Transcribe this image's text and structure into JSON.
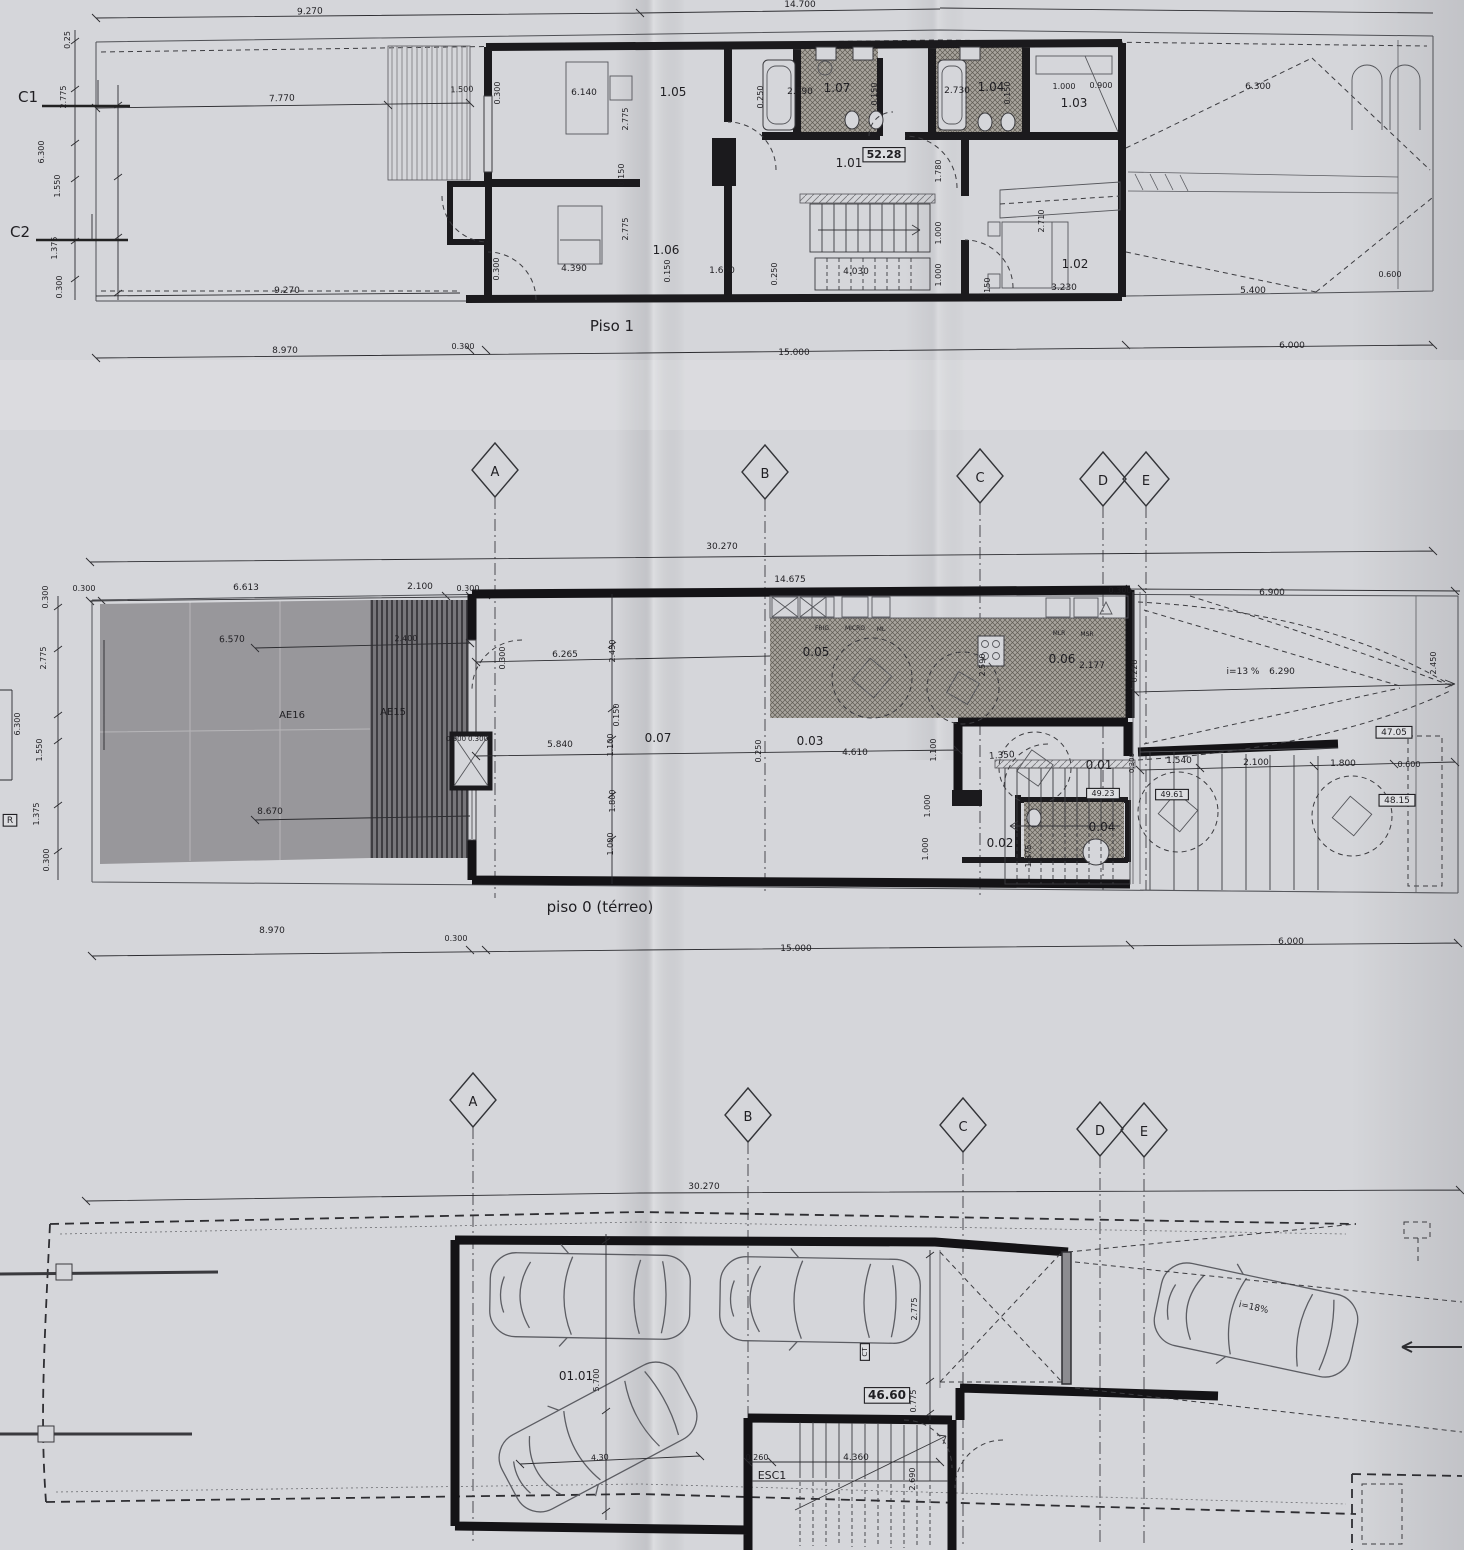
{
  "document": {
    "kind": "scanned architectural plan sheet (photograph of folded print)",
    "plans": [
      {
        "title": "Piso 1",
        "rooms": [
          "1.01",
          "1.02",
          "1.03",
          "1.04",
          "1.05",
          "1.06",
          "1.07"
        ],
        "level_box": "52.28"
      },
      {
        "title": "piso 0 (térreo)",
        "rooms": [
          "0.01",
          "0.02",
          "0.03",
          "0.04",
          "0.05",
          "0.06",
          "0.07"
        ],
        "zones": [
          "AE16",
          "AE15"
        ],
        "level_boxes": [
          "47.05",
          "48.15",
          "49.23",
          "49.61"
        ],
        "ramp": "i=13 %"
      },
      {
        "title": "garagem (piso -1)",
        "rooms": [
          "01.01"
        ],
        "level_box": "46.60",
        "refs": [
          "ESC1",
          "CT"
        ],
        "ramp": "i=18%"
      }
    ],
    "grid_letters": [
      "A",
      "B",
      "C",
      "D",
      "E"
    ],
    "section_refs": [
      "C1",
      "C2",
      "R"
    ],
    "overall_dim": "30.270"
  },
  "colors": {
    "paper": "#d5d6da",
    "ink": "#1f1e22",
    "wall": "#1b1a1d",
    "terrace_gray": "#98979b",
    "deck_dark": "#6e6d70",
    "hatch_base": "#a8a49d"
  },
  "labels": [
    {
      "n": "dim-label",
      "t": "9.270",
      "x": 310,
      "y": 14,
      "fs": 9,
      "r": -2
    },
    {
      "n": "dim-label",
      "t": "14.700",
      "x": 800,
      "y": 7,
      "fs": 9
    },
    {
      "n": "section-ref",
      "t": "C1",
      "x": 28,
      "y": 102,
      "fs": 15
    },
    {
      "n": "section-ref",
      "t": "C2",
      "x": 20,
      "y": 237,
      "fs": 15
    },
    {
      "n": "dim-label",
      "t": "0.25",
      "x": 70,
      "y": 40,
      "fs": 8,
      "r": -90
    },
    {
      "n": "dim-label",
      "t": "2.775",
      "x": 66,
      "y": 97,
      "fs": 8,
      "r": -90
    },
    {
      "n": "dim-label",
      "t": "6.300",
      "x": 44,
      "y": 152,
      "fs": 8,
      "r": -90
    },
    {
      "n": "dim-label",
      "t": "1.550",
      "x": 60,
      "y": 186,
      "fs": 8,
      "r": -90
    },
    {
      "n": "dim-label",
      "t": "1.375",
      "x": 57,
      "y": 248,
      "fs": 8,
      "r": -90
    },
    {
      "n": "dim-label",
      "t": "0.300",
      "x": 62,
      "y": 287,
      "fs": 8,
      "r": -90
    },
    {
      "n": "dim-label",
      "t": "7.770",
      "x": 282,
      "y": 101,
      "fs": 9,
      "r": -2
    },
    {
      "n": "dim-label",
      "t": "1.500",
      "x": 462,
      "y": 92,
      "fs": 8,
      "r": -2
    },
    {
      "n": "dim-label",
      "t": "0.300",
      "x": 500,
      "y": 93,
      "fs": 8,
      "r": -90
    },
    {
      "n": "dim-label",
      "t": "6.140",
      "x": 584,
      "y": 95,
      "fs": 9
    },
    {
      "n": "room-label",
      "t": "1.05",
      "x": 673,
      "y": 96,
      "fs": 12
    },
    {
      "n": "dim-label",
      "t": "0.250",
      "x": 763,
      "y": 97,
      "fs": 8,
      "r": -90
    },
    {
      "n": "dim-label",
      "t": "2.590",
      "x": 800,
      "y": 94,
      "fs": 9
    },
    {
      "n": "room-label",
      "t": "1.07",
      "x": 837,
      "y": 92,
      "fs": 12
    },
    {
      "n": "dim-label",
      "t": "0.150",
      "x": 877,
      "y": 94,
      "fs": 8,
      "r": -90
    },
    {
      "n": "dim-label",
      "t": "2.730",
      "x": 957,
      "y": 93,
      "fs": 9
    },
    {
      "n": "room-label",
      "t": "1.04",
      "x": 991,
      "y": 91,
      "fs": 12
    },
    {
      "n": "dim-label",
      "t": "0.150",
      "x": 1010,
      "y": 93,
      "fs": 8,
      "r": -90
    },
    {
      "n": "dim-label",
      "t": "1.000",
      "x": 1064,
      "y": 89,
      "fs": 8
    },
    {
      "n": "dim-label",
      "t": "0.900",
      "x": 1101,
      "y": 88,
      "fs": 8
    },
    {
      "n": "room-label",
      "t": "1.03",
      "x": 1074,
      "y": 107,
      "fs": 12
    },
    {
      "n": "dim-label",
      "t": "6.300",
      "x": 1258,
      "y": 89,
      "fs": 9
    },
    {
      "n": "dim-label",
      "t": "2.775",
      "x": 628,
      "y": 119,
      "fs": 8,
      "r": -90
    },
    {
      "n": "dim-label",
      "t": "0.150",
      "x": 624,
      "y": 175,
      "fs": 8,
      "r": -90
    },
    {
      "n": "dim-label",
      "t": "2.775",
      "x": 628,
      "y": 229,
      "fs": 8,
      "r": -90
    },
    {
      "n": "level-box",
      "t": "52.28",
      "x": 884,
      "y": 158,
      "fs": 11,
      "b": 1,
      "box": 1
    },
    {
      "n": "room-label",
      "t": "1.01",
      "x": 849,
      "y": 167,
      "fs": 12
    },
    {
      "n": "dim-label",
      "t": "1.780",
      "x": 941,
      "y": 171,
      "fs": 8,
      "r": -90
    },
    {
      "n": "dim-label",
      "t": "1.000",
      "x": 941,
      "y": 233,
      "fs": 8,
      "r": -90
    },
    {
      "n": "dim-label",
      "t": "1.000",
      "x": 941,
      "y": 275,
      "fs": 8,
      "r": -90
    },
    {
      "n": "dim-label",
      "t": "2.710",
      "x": 1044,
      "y": 221,
      "fs": 8,
      "r": -90
    },
    {
      "n": "room-label",
      "t": "1.06",
      "x": 666,
      "y": 254,
      "fs": 12
    },
    {
      "n": "room-label",
      "t": "1.02",
      "x": 1075,
      "y": 268,
      "fs": 12
    },
    {
      "n": "dim-label",
      "t": "4.390",
      "x": 574,
      "y": 271,
      "fs": 9
    },
    {
      "n": "dim-label",
      "t": "0.150",
      "x": 670,
      "y": 271,
      "fs": 8,
      "r": -90
    },
    {
      "n": "dim-label",
      "t": "1.600",
      "x": 722,
      "y": 273,
      "fs": 9
    },
    {
      "n": "dim-label",
      "t": "0.250",
      "x": 777,
      "y": 274,
      "fs": 8,
      "r": -90
    },
    {
      "n": "dim-label",
      "t": "4.030",
      "x": 856,
      "y": 274,
      "fs": 9
    },
    {
      "n": "dim-label",
      "t": "0.300",
      "x": 499,
      "y": 269,
      "fs": 8,
      "r": -90
    },
    {
      "n": "dim-label",
      "t": "0.150",
      "x": 990,
      "y": 289,
      "fs": 8,
      "r": -90
    },
    {
      "n": "dim-label",
      "t": "3.230",
      "x": 1064,
      "y": 290,
      "fs": 9
    },
    {
      "n": "dim-label",
      "t": "5.400",
      "x": 1253,
      "y": 293,
      "fs": 9
    },
    {
      "n": "dim-label",
      "t": "0.600",
      "x": 1390,
      "y": 277,
      "fs": 8
    },
    {
      "n": "dim-label",
      "t": "9.270",
      "x": 287,
      "y": 293,
      "fs": 9
    },
    {
      "n": "plan-title",
      "t": "Piso 1",
      "x": 612,
      "y": 331,
      "fs": 15
    },
    {
      "n": "dim-label",
      "t": "8.970",
      "x": 285,
      "y": 353,
      "fs": 9
    },
    {
      "n": "dim-label",
      "t": "0.300",
      "x": 463,
      "y": 349,
      "fs": 8
    },
    {
      "n": "dim-label",
      "t": "15.000",
      "x": 794,
      "y": 355,
      "fs": 9
    },
    {
      "n": "dim-label",
      "t": "6.000",
      "x": 1292,
      "y": 348,
      "fs": 9
    },
    {
      "n": "grid-letter",
      "t": "A",
      "x": 495,
      "y": 476,
      "fs": 13
    },
    {
      "n": "grid-letter",
      "t": "B",
      "x": 765,
      "y": 478,
      "fs": 13
    },
    {
      "n": "grid-letter",
      "t": "C",
      "x": 980,
      "y": 482,
      "fs": 13
    },
    {
      "n": "grid-letter",
      "t": "D",
      "x": 1103,
      "y": 485,
      "fs": 13
    },
    {
      "n": "grid-letter",
      "t": "E",
      "x": 1146,
      "y": 485,
      "fs": 13
    },
    {
      "n": "dim-label",
      "t": "30.270",
      "x": 722,
      "y": 549,
      "fs": 9
    },
    {
      "n": "dim-label",
      "t": "0.300",
      "x": 84,
      "y": 591,
      "fs": 8
    },
    {
      "n": "dim-label",
      "t": "6.613",
      "x": 246,
      "y": 590,
      "fs": 9
    },
    {
      "n": "dim-label",
      "t": "2.100",
      "x": 420,
      "y": 589,
      "fs": 9
    },
    {
      "n": "dim-label",
      "t": "0.300",
      "x": 468,
      "y": 591,
      "fs": 8
    },
    {
      "n": "dim-label",
      "t": "14.675",
      "x": 790,
      "y": 582,
      "fs": 9
    },
    {
      "n": "dim-label",
      "t": "0.300",
      "x": 1120,
      "y": 593,
      "fs": 8
    },
    {
      "n": "dim-label",
      "t": "6.900",
      "x": 1272,
      "y": 595,
      "fs": 9
    },
    {
      "n": "dim-label",
      "t": "0.300",
      "x": 48,
      "y": 597,
      "fs": 8,
      "r": -90
    },
    {
      "n": "dim-label",
      "t": "2.775",
      "x": 46,
      "y": 658,
      "fs": 8,
      "r": -90
    },
    {
      "n": "dim-label",
      "t": "6.300",
      "x": 20,
      "y": 724,
      "fs": 8,
      "r": -90
    },
    {
      "n": "dim-label",
      "t": "1.550",
      "x": 42,
      "y": 750,
      "fs": 8,
      "r": -90
    },
    {
      "n": "dim-label",
      "t": "1.375",
      "x": 39,
      "y": 814,
      "fs": 8,
      "r": -90
    },
    {
      "n": "dim-label",
      "t": "0.300",
      "x": 49,
      "y": 860,
      "fs": 8,
      "r": -90
    },
    {
      "n": "section-ref",
      "t": "R",
      "x": 10,
      "y": 823,
      "fs": 9,
      "box": 1
    },
    {
      "n": "dim-label",
      "t": "6.570",
      "x": 232,
      "y": 642,
      "fs": 9,
      "r": -1
    },
    {
      "n": "zone-label",
      "t": "AE16",
      "x": 292,
      "y": 718,
      "fs": 10
    },
    {
      "n": "zone-label",
      "t": "AE15",
      "x": 393,
      "y": 715,
      "fs": 10
    },
    {
      "n": "dim-label",
      "t": "8.670",
      "x": 270,
      "y": 814,
      "fs": 9
    },
    {
      "n": "dim-label",
      "t": "2.400",
      "x": 406,
      "y": 641,
      "fs": 8,
      "r": -1
    },
    {
      "n": "dim-label",
      "t": "0.900",
      "x": 456,
      "y": 741,
      "fs": 7
    },
    {
      "n": "dim-label",
      "t": "0.300",
      "x": 478,
      "y": 741,
      "fs": 7
    },
    {
      "n": "dim-label",
      "t": "0.300",
      "x": 505,
      "y": 658,
      "fs": 8,
      "r": -90
    },
    {
      "n": "dim-label",
      "t": "6.265",
      "x": 565,
      "y": 657,
      "fs": 9
    },
    {
      "n": "dim-label",
      "t": "2.450",
      "x": 615,
      "y": 651,
      "fs": 8,
      "r": -90
    },
    {
      "n": "dim-label",
      "t": "0.150",
      "x": 619,
      "y": 715,
      "fs": 8,
      "r": -90
    },
    {
      "n": "dim-label",
      "t": "1.100",
      "x": 613,
      "y": 745,
      "fs": 8,
      "r": -90
    },
    {
      "n": "room-label",
      "t": "0.07",
      "x": 658,
      "y": 742,
      "fs": 12
    },
    {
      "n": "dim-label",
      "t": "5.840",
      "x": 560,
      "y": 747,
      "fs": 9
    },
    {
      "n": "dim-label",
      "t": "1.800",
      "x": 615,
      "y": 801,
      "fs": 8,
      "r": -90
    },
    {
      "n": "dim-label",
      "t": "1.000",
      "x": 613,
      "y": 844,
      "fs": 8,
      "r": -90
    },
    {
      "n": "appliance-label",
      "t": "FRIG",
      "x": 822,
      "y": 630,
      "fs": 6
    },
    {
      "n": "appliance-label",
      "t": "MICRO",
      "x": 855,
      "y": 630,
      "fs": 6
    },
    {
      "n": "appliance-label",
      "t": "ML",
      "x": 881,
      "y": 631,
      "fs": 6
    },
    {
      "n": "room-label",
      "t": "0.05",
      "x": 816,
      "y": 656,
      "fs": 12
    },
    {
      "n": "dim-label",
      "t": "2.590",
      "x": 985,
      "y": 665,
      "fs": 8,
      "r": -90
    },
    {
      "n": "appliance-label",
      "t": "MLR",
      "x": 1059,
      "y": 635,
      "fs": 6
    },
    {
      "n": "appliance-label",
      "t": "MSR",
      "x": 1087,
      "y": 636,
      "fs": 6
    },
    {
      "n": "room-label",
      "t": "0.06",
      "x": 1062,
      "y": 663,
      "fs": 12
    },
    {
      "n": "dim-label",
      "t": "2.177",
      "x": 1092,
      "y": 668,
      "fs": 9
    },
    {
      "n": "dim-label",
      "t": "0.228",
      "x": 1137,
      "y": 671,
      "fs": 8,
      "r": -90
    },
    {
      "n": "ramp-slope-label",
      "t": "i=13 %",
      "x": 1243,
      "y": 674,
      "fs": 9
    },
    {
      "n": "dim-label",
      "t": "6.290",
      "x": 1282,
      "y": 674,
      "fs": 9
    },
    {
      "n": "dim-label",
      "t": "2.450",
      "x": 1436,
      "y": 663,
      "fs": 8,
      "r": -90
    },
    {
      "n": "level-box",
      "t": "47.05",
      "x": 1394,
      "y": 735,
      "fs": 9,
      "box": 1
    },
    {
      "n": "room-label",
      "t": "0.03",
      "x": 810,
      "y": 745,
      "fs": 12
    },
    {
      "n": "dim-label",
      "t": "0.250",
      "x": 761,
      "y": 751,
      "fs": 8,
      "r": -90
    },
    {
      "n": "dim-label",
      "t": "4.610",
      "x": 855,
      "y": 755,
      "fs": 9
    },
    {
      "n": "dim-label",
      "t": "1.100",
      "x": 936,
      "y": 750,
      "fs": 8,
      "r": -90
    },
    {
      "n": "dim-label",
      "t": "1.000",
      "x": 930,
      "y": 806,
      "fs": 8,
      "r": -90
    },
    {
      "n": "dim-label",
      "t": "1.000",
      "x": 928,
      "y": 849,
      "fs": 8,
      "r": -90
    },
    {
      "n": "dim-label",
      "t": "1.350",
      "x": 1002,
      "y": 758,
      "fs": 9,
      "r": -4
    },
    {
      "n": "room-label",
      "t": "0.01",
      "x": 1099,
      "y": 769,
      "fs": 12
    },
    {
      "n": "level-box",
      "t": "49.23",
      "x": 1103,
      "y": 796,
      "fs": 8,
      "box": 1
    },
    {
      "n": "dim-label",
      "t": "0.300",
      "x": 1134,
      "y": 763,
      "fs": 7,
      "r": -90
    },
    {
      "n": "dim-label",
      "t": "1.540",
      "x": 1179,
      "y": 763,
      "fs": 9
    },
    {
      "n": "dim-label",
      "t": "2.100",
      "x": 1256,
      "y": 765,
      "fs": 9
    },
    {
      "n": "dim-label",
      "t": "1.800",
      "x": 1343,
      "y": 766,
      "fs": 9
    },
    {
      "n": "dim-label",
      "t": "0.600",
      "x": 1409,
      "y": 767,
      "fs": 8
    },
    {
      "n": "level-box",
      "t": "49.61",
      "x": 1172,
      "y": 797,
      "fs": 8,
      "box": 1
    },
    {
      "n": "level-box",
      "t": "48.15",
      "x": 1397,
      "y": 803,
      "fs": 9,
      "box": 1
    },
    {
      "n": "room-label",
      "t": "0.02",
      "x": 1000,
      "y": 847,
      "fs": 12
    },
    {
      "n": "room-label",
      "t": "0.04",
      "x": 1102,
      "y": 831,
      "fs": 12
    },
    {
      "n": "dim-label",
      "t": "1.375",
      "x": 1031,
      "y": 856,
      "fs": 8,
      "r": -90
    },
    {
      "n": "plan-title",
      "t": "piso 0 (térreo)",
      "x": 600,
      "y": 912,
      "fs": 15
    },
    {
      "n": "dim-label",
      "t": "8.970",
      "x": 272,
      "y": 933,
      "fs": 9
    },
    {
      "n": "dim-label",
      "t": "0.300",
      "x": 456,
      "y": 941,
      "fs": 8
    },
    {
      "n": "dim-label",
      "t": "15.000",
      "x": 796,
      "y": 951,
      "fs": 9
    },
    {
      "n": "dim-label",
      "t": "6.000",
      "x": 1291,
      "y": 944,
      "fs": 9
    },
    {
      "n": "grid-letter",
      "t": "A",
      "x": 473,
      "y": 1106,
      "fs": 13
    },
    {
      "n": "grid-letter",
      "t": "B",
      "x": 748,
      "y": 1121,
      "fs": 13
    },
    {
      "n": "grid-letter",
      "t": "C",
      "x": 963,
      "y": 1131,
      "fs": 13
    },
    {
      "n": "grid-letter",
      "t": "D",
      "x": 1100,
      "y": 1135,
      "fs": 13
    },
    {
      "n": "grid-letter",
      "t": "E",
      "x": 1144,
      "y": 1136,
      "fs": 13
    },
    {
      "n": "dim-label",
      "t": "30.270",
      "x": 704,
      "y": 1189,
      "fs": 9
    },
    {
      "n": "room-label",
      "t": "01.01",
      "x": 576,
      "y": 1380,
      "fs": 12
    },
    {
      "n": "dim-label",
      "t": "5.700",
      "x": 599,
      "y": 1380,
      "fs": 8,
      "r": -90
    },
    {
      "n": "dim-label",
      "t": "4.30",
      "x": 600,
      "y": 1460,
      "fs": 8,
      "r": -3
    },
    {
      "n": "ref-label",
      "t": "CT",
      "x": 867,
      "y": 1352,
      "fs": 7,
      "r": -90,
      "box": 1
    },
    {
      "n": "dim-label",
      "t": "2.775",
      "x": 917,
      "y": 1309,
      "fs": 8,
      "r": -90
    },
    {
      "n": "level-box",
      "t": "46.60",
      "x": 887,
      "y": 1399,
      "fs": 12,
      "b": 1,
      "box": 1
    },
    {
      "n": "dim-label",
      "t": "0.775",
      "x": 916,
      "y": 1401,
      "fs": 8,
      "r": -90
    },
    {
      "n": "dim-label",
      "t": "0.260",
      "x": 757,
      "y": 1460,
      "fs": 8
    },
    {
      "n": "dim-label",
      "t": "4.360",
      "x": 856,
      "y": 1460,
      "fs": 9
    },
    {
      "n": "ref-label",
      "t": "ESC1",
      "x": 772,
      "y": 1479,
      "fs": 11
    },
    {
      "n": "dim-label",
      "t": "2.690",
      "x": 915,
      "y": 1479,
      "fs": 8,
      "r": -90
    },
    {
      "n": "ramp-slope-label",
      "t": "i=18%",
      "x": 1253,
      "y": 1310,
      "fs": 9,
      "r": 12
    }
  ]
}
